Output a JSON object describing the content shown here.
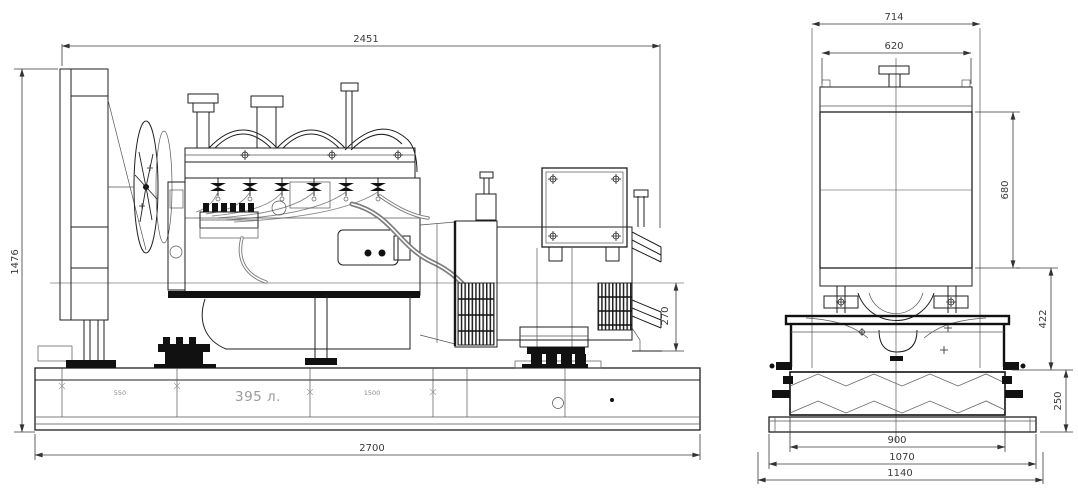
{
  "page": {
    "background": "#ffffff",
    "line_color": "#1f1f1f",
    "dim_color": "#3a3a3a"
  },
  "side_view": {
    "dimensions": {
      "overall_length": "2451",
      "overall_height": "1476",
      "axis_to_base": "270",
      "base_length": "2700"
    },
    "base": {
      "left_segment": "550",
      "tank_capacity": "395 л.",
      "right_segment": "1500"
    }
  },
  "front_view": {
    "dimensions": {
      "overall_width": "714",
      "radiator_core_width": "620",
      "radiator_core_height": "680",
      "core_bottom_to_skid": "422",
      "tank_height": "250",
      "tank_width": "900",
      "skid_plate_width": "1070",
      "overall_base_width": "1140"
    }
  }
}
